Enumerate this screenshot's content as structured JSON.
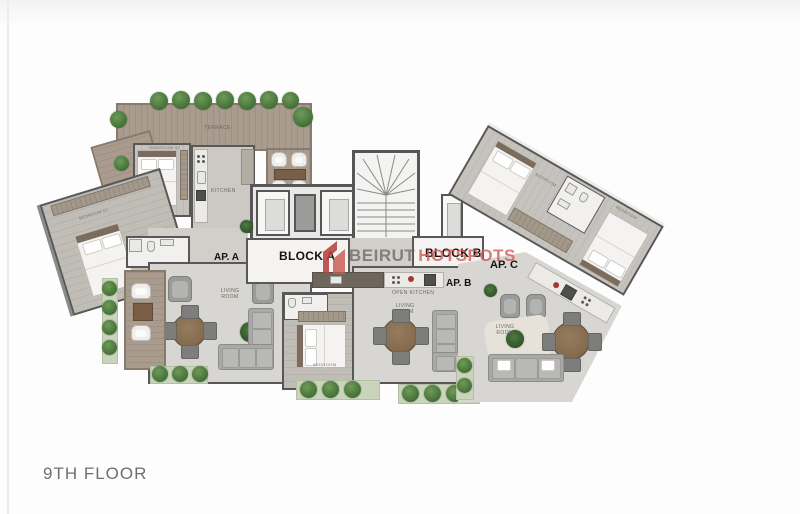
{
  "page": {
    "floor_title": "9TH FLOOR"
  },
  "watermark": {
    "part1": "BEIRUT",
    "part2": "HOTSPOTS"
  },
  "labels": {
    "block_a": "BLOCK A",
    "block_b": "BLOCK B",
    "ap_a": "AP. A",
    "ap_b": "AP. B",
    "ap_c": "AP. C",
    "terrace": "TERRACE",
    "bedroom_01": "BEDROOM 01",
    "bedroom_02": "BEDROOM 02",
    "bedroom": "BEDROOM",
    "kitchen": "KITCHEN",
    "open_kitchen": "OPEN KITCHEN",
    "living_room": "LIVING ROOM"
  },
  "palette": {
    "wall": "#585858",
    "floor_gray": "#d8d6d2",
    "deck_wood": "#a99c8e",
    "greenery": "#4c7a3e",
    "label_dark": "#141414",
    "room_label": "#6b675f",
    "watermark_red": "#c85a50",
    "watermark_gray": "#696969",
    "floor_title_gray": "#6f6f6f",
    "background": "#fdfdfd"
  }
}
